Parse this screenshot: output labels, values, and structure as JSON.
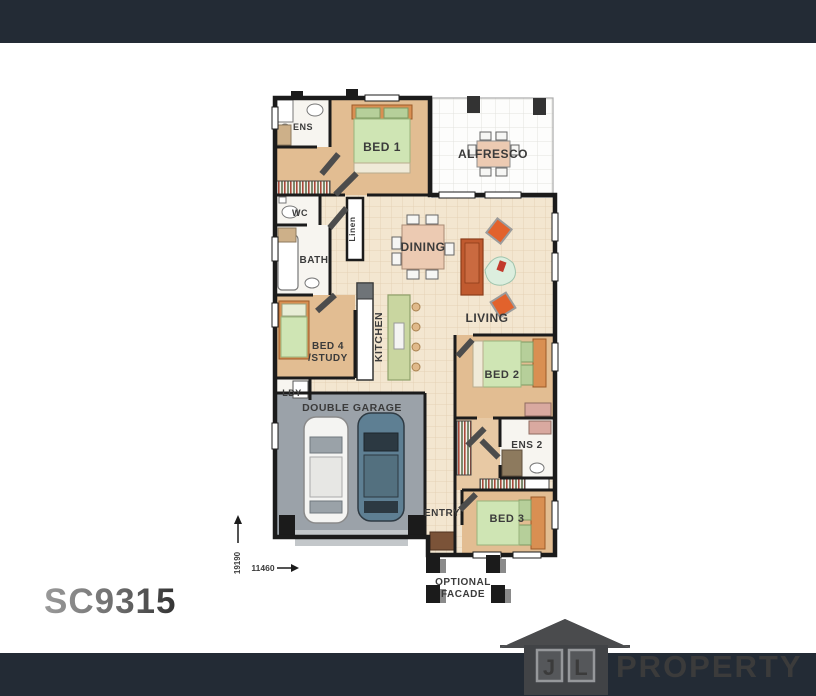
{
  "plan": {
    "code": "SC9315",
    "dimensions": {
      "depth": "19190",
      "width": "11460"
    },
    "rooms": {
      "ens": "ENS",
      "bed1": "BED 1",
      "alfresco": "ALFRESCO",
      "wc": "WC",
      "linen": "Linen",
      "dining": "DINING",
      "bath": "BATH",
      "kitchen": "KITCHEN",
      "bed4_line1": "BED 4",
      "bed4_line2": "/STUDY",
      "living": "LIVING",
      "bed2": "BED 2",
      "ldy": "LDY",
      "garage": "DOUBLE GARAGE",
      "ens2": "ENS 2",
      "entry": "ENTRY",
      "bed3": "BED 3",
      "facade_line1": "OPTIONAL",
      "facade_line2": "FACADE"
    }
  },
  "logo": {
    "letter_j": "J",
    "letter_l": "L",
    "word": "PROPERTY"
  },
  "colors": {
    "header_footer_bar": "#232b35",
    "wall": "#1b1b1b",
    "floor_tile": "#f3e6d0",
    "floor_bedroom": "#e2bd92",
    "floor_garage": "#9ba2a9",
    "bed_quilt": "#cfe5b4",
    "sofa": "#c05a2f",
    "armchair": "#e2622c",
    "kitchen_island": "#c9d6a0",
    "logo_gray": "#4a4b4d",
    "code_gray": "#5a5a5a"
  }
}
